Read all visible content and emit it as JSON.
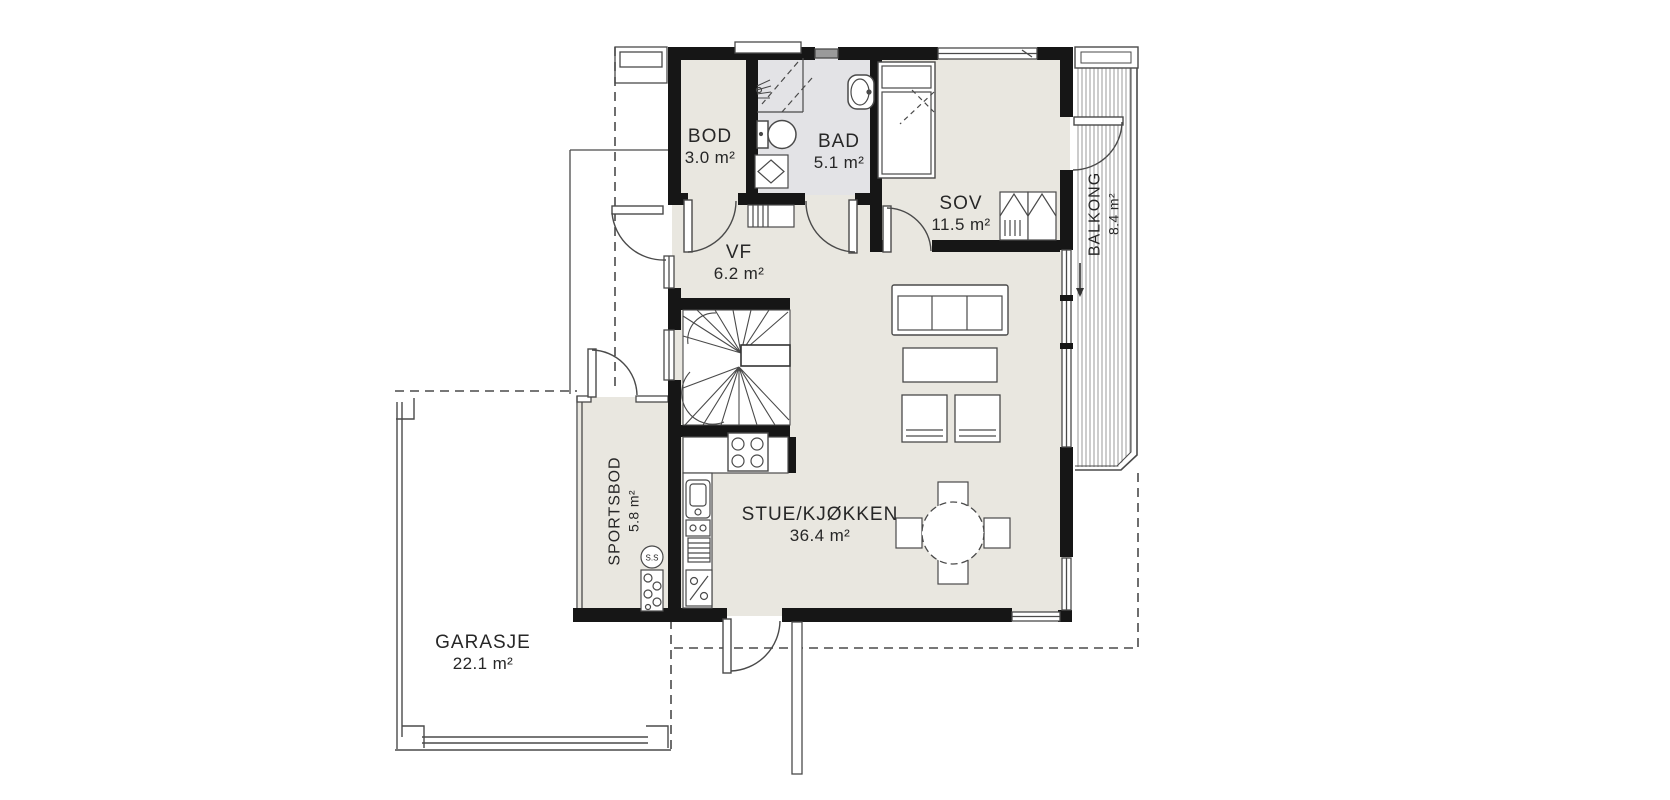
{
  "plan": {
    "rooms": [
      {
        "id": "bod",
        "name": "BOD",
        "area": "3.0 m²"
      },
      {
        "id": "bad",
        "name": "BAD",
        "area": "5.1 m²"
      },
      {
        "id": "sov",
        "name": "SOV",
        "area": "11.5 m²"
      },
      {
        "id": "vf",
        "name": "VF",
        "area": "6.2 m²"
      },
      {
        "id": "stue_kjokken",
        "name": "STUE/KJØKKEN",
        "area": "36.4 m²"
      },
      {
        "id": "sportsbod",
        "name": "SPORTSBOD",
        "area": "5.8 m²"
      },
      {
        "id": "balkong",
        "name": "BALKONG",
        "area": "8.4 m²"
      },
      {
        "id": "garasje",
        "name": "GARASJE",
        "area": "22.1 m²"
      }
    ],
    "annotations": {
      "ss": {
        "text": "S.S"
      }
    },
    "colors": {
      "wall": "#161616",
      "interior_fill": "#e9e7e0",
      "bath_fill": "#e3e3e6",
      "line": "#4a4a4a"
    }
  }
}
